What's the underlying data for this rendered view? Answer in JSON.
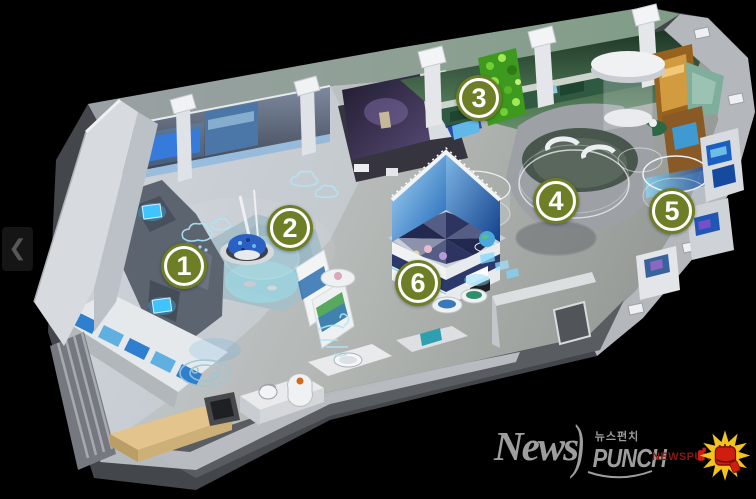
{
  "zones": [
    {
      "number": "1"
    },
    {
      "number": "2"
    },
    {
      "number": "3"
    },
    {
      "number": "4"
    },
    {
      "number": "5"
    },
    {
      "number": "6"
    }
  ],
  "carousel": {
    "prev_glyph": "❮"
  },
  "logo": {
    "news": "News",
    "swoosh": ")",
    "korean": "뉴스펀치",
    "punch": "PUNCH",
    "brand_small": "NEWSPUNCH"
  },
  "colors": {
    "background": "#000000",
    "badge_fill": "#6e7e26",
    "badge_ring": "#ffffff",
    "badge_text": "#ffffff",
    "logo_gray": "#9d9d9d",
    "brand_red": "#8a1a10",
    "star_yellow": "#f2c31c",
    "glove_red": "#cf1d10"
  }
}
